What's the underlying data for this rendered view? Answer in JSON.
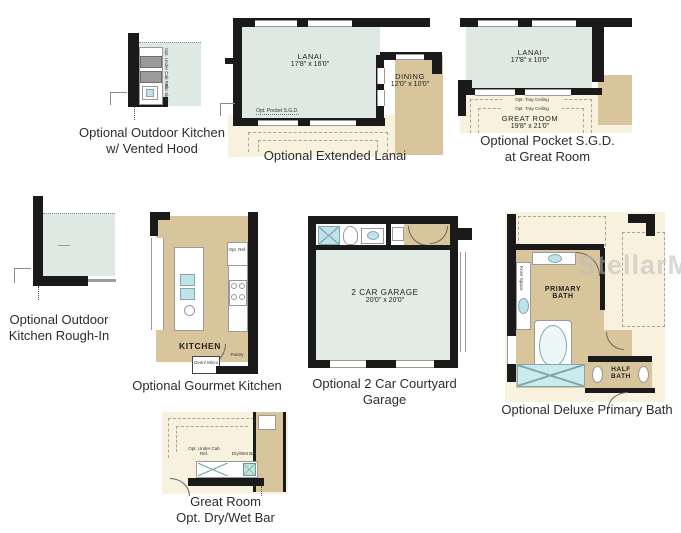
{
  "watermark": "StellarMLS",
  "colors": {
    "lanai_green": "#dee9e3",
    "garage_green": "#e3ebe5",
    "room_tan": "#d9c59c",
    "outdoor_cream": "#f7f1de",
    "wall_black": "#1a1a1a",
    "fixture_blue": "#bfe3e8",
    "caption_text": "#2d2d2d"
  },
  "plans": {
    "outdoor_kitchen_hood": {
      "caption_line1": "Optional Outdoor Kitchen",
      "caption_line2": "w/ Vented Hood",
      "label_cab_ref": "Opt. Under Cab Ref.",
      "label_bar_sink": "Bar Sink"
    },
    "extended_lanai": {
      "caption": "Optional Extended Lanai",
      "lanai_name": "LANAI",
      "lanai_dims": "17'8\" x 16'0\"",
      "dining_name": "DINING",
      "dining_dims": "12'0\" x 10'0\"",
      "label_pocket": "Opt. Pocket S.G.D."
    },
    "pocket_sgd": {
      "caption_line1": "Optional Pocket S.G.D.",
      "caption_line2": "at Great Room",
      "lanai_name": "LANAI",
      "lanai_dims": "17'8\" x 10'0\"",
      "tray_label_1": "Opt. Tray Ceiling",
      "tray_label_2": "Opt. Tray Ceiling",
      "great_room_name": "GREAT ROOM",
      "great_room_dims": "19'8\" x 21'0\""
    },
    "outdoor_kitchen_roughin": {
      "caption_line1": "Optional Outdoor",
      "caption_line2": "Kitchen Rough-In"
    },
    "gourmet_kitchen": {
      "caption": "Optional Gourmet Kitchen",
      "room_name": "KITCHEN",
      "label_ref": "Opt. Ref.",
      "label_pantry": "Pantry",
      "label_oven_micro": "Oven/ Micro"
    },
    "courtyard_garage": {
      "caption": "Optional 2 Car Courtyard Garage",
      "room_name": "2 CAR GARAGE",
      "room_dims": "20'0\" x 20'0\""
    },
    "deluxe_bath": {
      "caption": "Optional Deluxe Primary Bath",
      "primary_name_line1": "PRIMARY",
      "primary_name_line2": "BATH",
      "half_name_line1": "HALF",
      "half_name_line2": "BATH",
      "label_knee_space": "Knee Space"
    },
    "dry_wet_bar": {
      "caption_line1": "Great Room",
      "caption_line2": "Opt. Dry/Wet Bar",
      "label_cab_ref": "Opt. Under Cab Ref.",
      "label_bar": "Dry/Wet Bar"
    }
  }
}
